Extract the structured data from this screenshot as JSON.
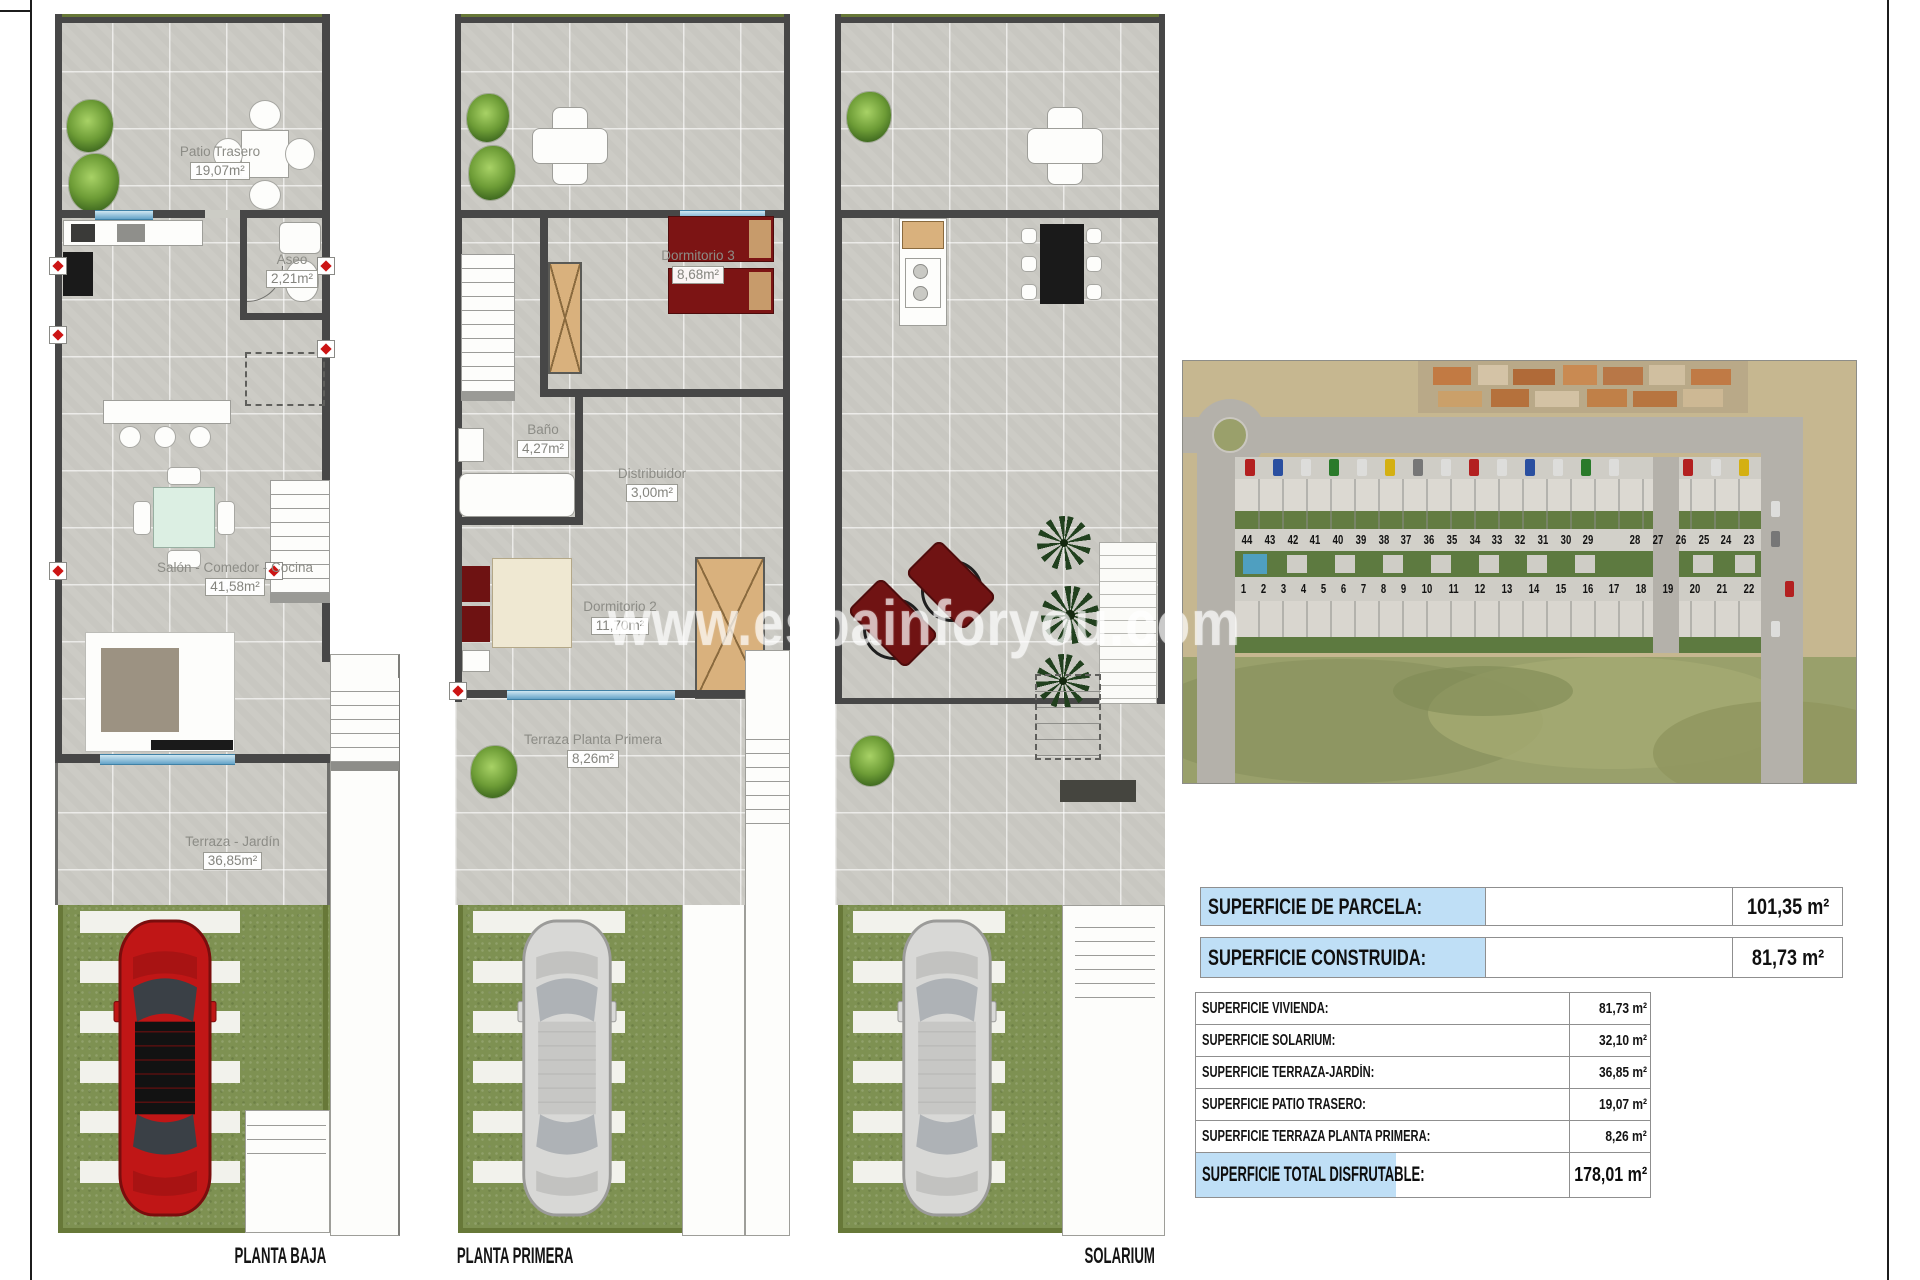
{
  "sheet": {
    "watermark": "www.espainforyou.com"
  },
  "plans": {
    "planta_baja": {
      "label": "PLANTA BAJA",
      "rooms": {
        "patio_trasero": {
          "name": "Patio Trasero",
          "area": "19,07m²"
        },
        "aseo": {
          "name": "Aseo",
          "area": "2,21m²"
        },
        "salon_comedor_cocina": {
          "name": "Salón - Comedor - Cocina",
          "area": "41,58m²"
        },
        "terraza_jardin": {
          "name": "Terraza - Jardín",
          "area": "36,85m²"
        }
      }
    },
    "planta_primera": {
      "label": "PLANTA PRIMERA",
      "rooms": {
        "dormitorio_3": {
          "name": "Dormitorio 3",
          "area": "8,68m²"
        },
        "bano": {
          "name": "Baño",
          "area": "4,27m²"
        },
        "distribuidor": {
          "name": "Distribuidor",
          "area": "3,00m²"
        },
        "dormitorio_2": {
          "name": "Dormitorio 2",
          "area": "11,70m²"
        },
        "terraza_planta_primera": {
          "name": "Terraza Planta Primera",
          "area": "8,26m²"
        }
      }
    },
    "solarium": {
      "label": "SOLARIUM"
    }
  },
  "aerial_photo": {
    "plot_numbers_back_row": [
      "44",
      "43",
      "42",
      "41",
      "40",
      "39",
      "38",
      "37",
      "36",
      "35",
      "34",
      "33",
      "32",
      "31",
      "30",
      "29",
      "28",
      "27",
      "26",
      "25",
      "24",
      "23"
    ],
    "plot_numbers_front_row": [
      "1",
      "2",
      "3",
      "4",
      "5",
      "6",
      "7",
      "8",
      "9",
      "10",
      "11",
      "12",
      "13",
      "14",
      "15",
      "16",
      "17",
      "18",
      "19",
      "20",
      "21",
      "22"
    ]
  },
  "summary_table": {
    "primary_rows": [
      {
        "label": "SUPERFICIE DE PARCELA:",
        "value": "101,35 m²"
      },
      {
        "label": "SUPERFICIE CONSTRUIDA:",
        "value": "81,73 m²"
      }
    ],
    "detail_rows": [
      {
        "label": "SUPERFICIE VIVIENDA:",
        "value": "81,73 m²"
      },
      {
        "label": "SUPERFICIE SOLARIUM:",
        "value": "32,10 m²"
      },
      {
        "label": "SUPERFICIE TERRAZA-JARDÍN:",
        "value": "36,85 m²"
      },
      {
        "label": "SUPERFICIE PATIO TRASERO:",
        "value": "19,07 m²"
      },
      {
        "label": "SUPERFICIE TERRAZA PLANTA PRIMERA:",
        "value": "8,26 m²"
      }
    ],
    "total_row": {
      "label": "SUPERFICIE TOTAL DISFRUTABLE:",
      "value": "178,01 m²"
    }
  },
  "colors": {
    "table_highlight": "#bfdff6",
    "car_red": "#c01616",
    "car_grey": "#d8d8d6",
    "garden_green": "#7e9152",
    "wall_grey": "#474747"
  }
}
